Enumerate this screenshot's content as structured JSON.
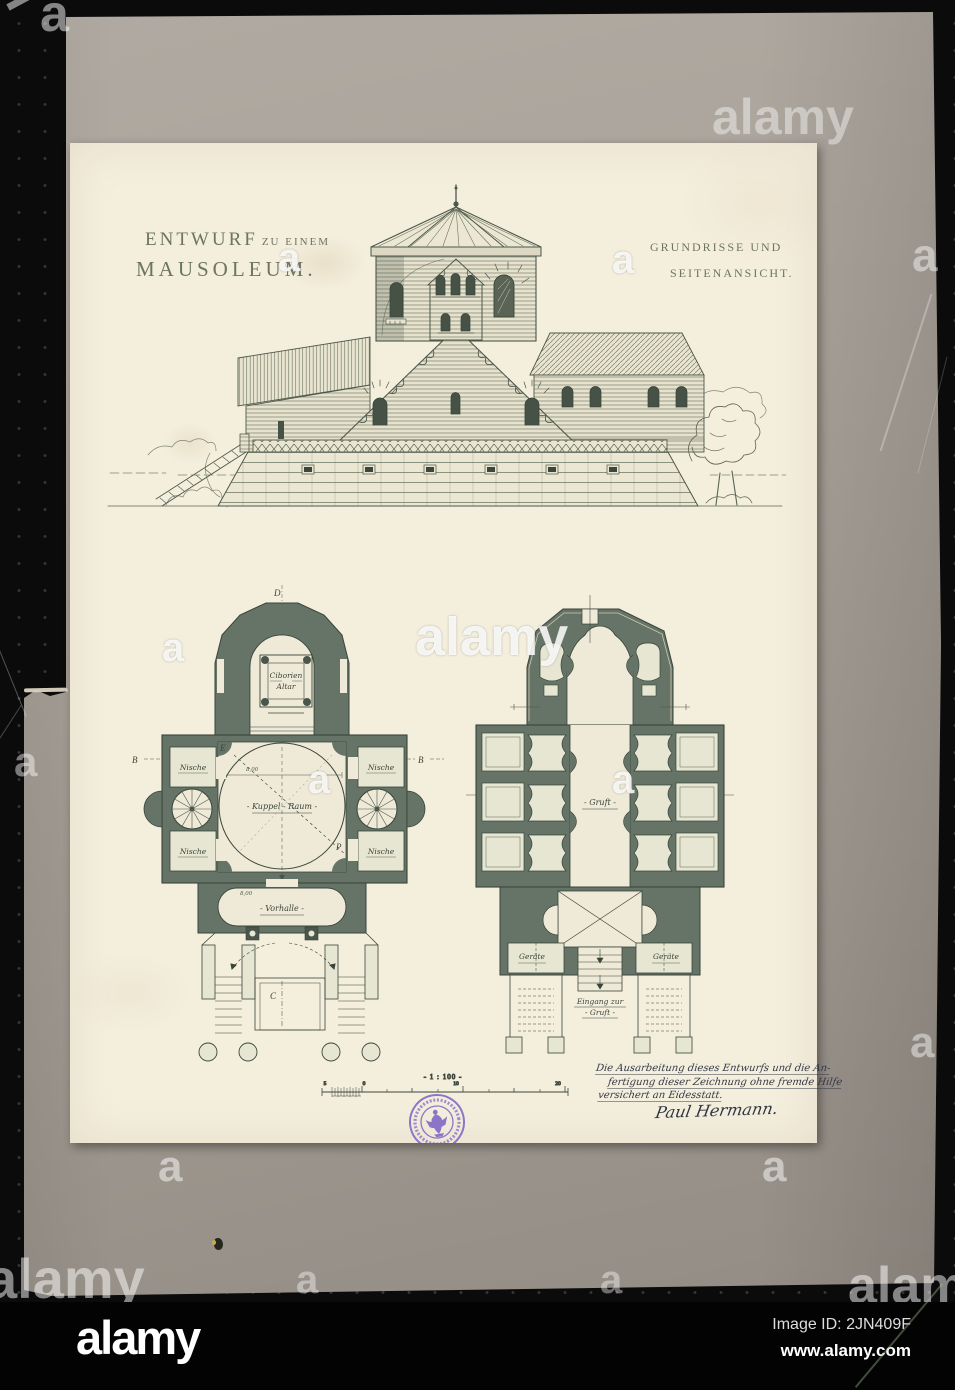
{
  "watermark": {
    "brand": "alamy",
    "letter": "a",
    "image_id": "Image ID: 2JN409F",
    "url": "www.alamy.com"
  },
  "titles": {
    "design": "ENTWURF",
    "design_small": "ZU EINEM",
    "subject": "MAUSOLEUM.",
    "right_line1": "GRUNDRISSE UND",
    "right_line2": "SEITENANSICHT."
  },
  "plans": {
    "upper": {
      "altar_line1": "Ciborien",
      "altar_line2": "Altar",
      "dome": "- Kuppel - Raum -",
      "niche": "Nische",
      "vestibule": "- Vorhalle -",
      "dim_dome": "8,00",
      "dim_vestibule": "8,00"
    },
    "crypt": {
      "hall": "- Gruft -",
      "equipment": "Geräte",
      "entrance_line1": "Eingang zur",
      "entrance_line2": "- Gruft -"
    },
    "letters": {
      "d": "D",
      "e": "E",
      "b": "B",
      "p": "P",
      "c": "C"
    },
    "scale": {
      "label": "- 1 : 100 -",
      "n5": "5",
      "n0": "0",
      "n10": "10",
      "n20": "20"
    }
  },
  "inscription": {
    "line1": "Die Ausarbeitung dieses Entwurfs und die An-",
    "line2": "fertigung dieser Zeichnung ohne fremde Hilfe",
    "line3": "versichert an Eidesstatt.",
    "signature": "Paul Hermann."
  },
  "colors": {
    "background": "#0b0b0b",
    "mount_board": "#a7a097",
    "paper": "#f4eedd",
    "ink": "#4d584c",
    "plan_walls": "#657467",
    "stamp": "#7f65c6",
    "watermark_bar": "#030303"
  }
}
